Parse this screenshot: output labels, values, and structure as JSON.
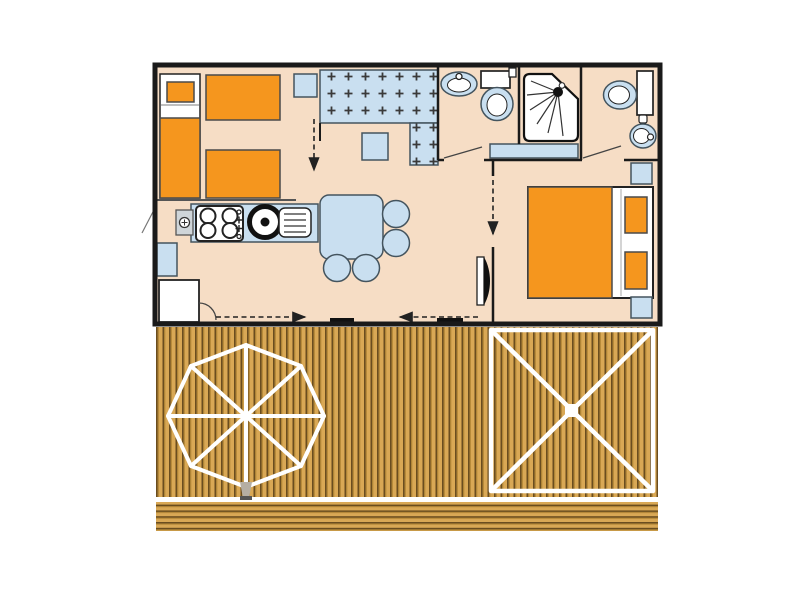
{
  "type": "floor-plan",
  "title": "",
  "palette": {
    "background": "#ffffff",
    "floor": "#f6ddc5",
    "furniture_blue": "#c9dff0",
    "accent_orange": "#f5961e",
    "wall": "#1a1a1a",
    "outline": "#44545e",
    "deck_wood": "#d9a855",
    "deck_line": "#6a4d1f",
    "deck_shadow": "#b08434",
    "white": "#ffffff"
  },
  "scene": {
    "bedroom_left": {
      "single_beds": 3,
      "pillows": 1,
      "nightstands": 1,
      "wardrobe": "cross-hatched"
    },
    "living_room": {
      "dining_table_seats": 4,
      "stools": 1
    },
    "kitchen": {
      "stove_burners": 4,
      "sink": "round",
      "items": [
        "water-heater",
        "drainboard",
        "fridge",
        "side-shelf"
      ]
    },
    "bathroom": {
      "items": [
        "washbasin",
        "toilet",
        "shower-cabin",
        "bench"
      ]
    },
    "wc": {
      "items": [
        "toilet",
        "washbasin"
      ]
    },
    "bedroom_right": {
      "bed": "double",
      "pillows": 2,
      "nightstands": 2
    },
    "terrace": {
      "parasol": "octagonal",
      "awning": "square-with-cross",
      "steps": "horizontal-planks"
    },
    "circulation_arrows": 4,
    "door_swings": 3
  }
}
